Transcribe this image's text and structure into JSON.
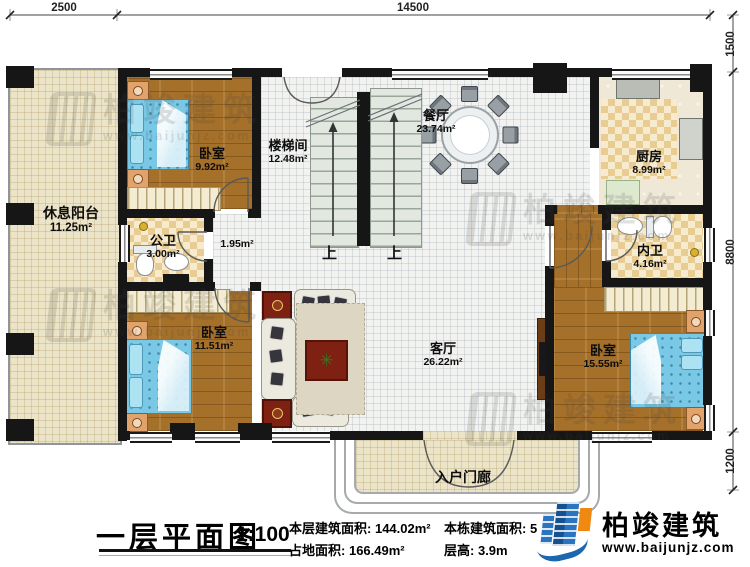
{
  "dimensions": {
    "top": [
      "2500",
      "14500"
    ],
    "right": [
      "1500",
      "8800",
      "1200"
    ]
  },
  "rooms": {
    "balcony": {
      "name": "休息阳台",
      "area": "11.25m²"
    },
    "bedroom_top_left": {
      "name": "卧室",
      "area": "9.92m²"
    },
    "stairwell": {
      "name": "楼梯间",
      "area": "12.48m²"
    },
    "dining": {
      "name": "餐厅",
      "area": "23.74m²"
    },
    "kitchen": {
      "name": "厨房",
      "area": "8.99m²"
    },
    "public_bath": {
      "name": "公卫",
      "area": "3.00m²"
    },
    "corridor": {
      "area": "1.95m²"
    },
    "bedroom_bottom_left": {
      "name": "卧室",
      "area": "11.51m²"
    },
    "living": {
      "name": "客厅",
      "area": "26.22m²"
    },
    "private_bath": {
      "name": "内卫",
      "area": "4.16m²"
    },
    "bedroom_right": {
      "name": "卧室",
      "area": "15.55m²"
    },
    "porch": {
      "name": "入户门廊"
    }
  },
  "stairs": {
    "up_label": "上"
  },
  "title_block": {
    "title": "一层平面图",
    "scale": "1:100",
    "stats": [
      {
        "label": "本层建筑面积:",
        "value": "144.02m²"
      },
      {
        "label": "占地面积:",
        "value": "166.49m²"
      },
      {
        "label": "本栋建筑面积:",
        "value": "5"
      },
      {
        "label": "层高:",
        "value": "3.9m"
      }
    ],
    "brand": {
      "name": "柏竣建筑",
      "url": "www.baijunjz.com"
    }
  },
  "watermark": {
    "text": "柏竣建筑",
    "url": "www.baijunjz.com"
  },
  "colors": {
    "wall": "#161616",
    "wood_floor": "#a5702a",
    "tile_checker": "#e8cc92",
    "bed_blue": "#79c9e6",
    "logo_blue": "#1d66b0",
    "logo_orange": "#f08912"
  }
}
